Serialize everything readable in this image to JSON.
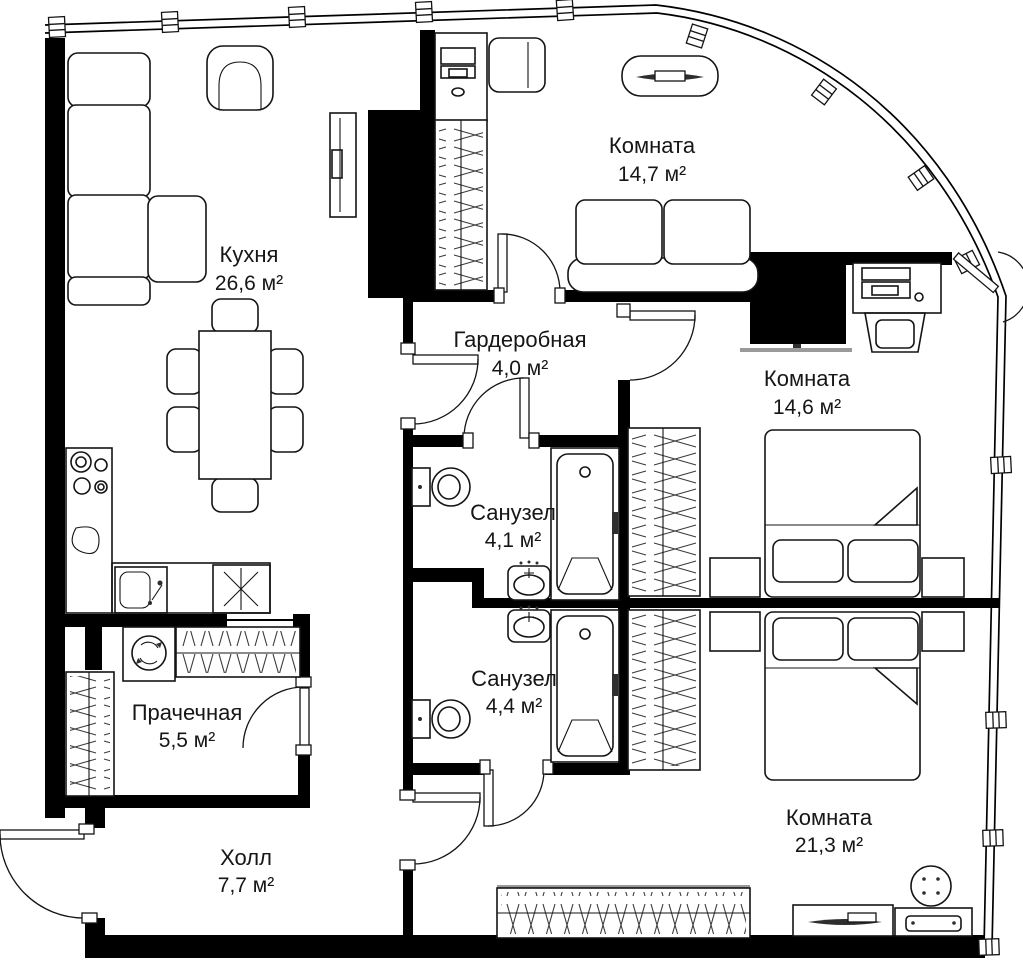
{
  "meta": {
    "type": "floor-plan",
    "language": "ru",
    "units": "м²"
  },
  "colors": {
    "walls": "#000000",
    "text": "#161616",
    "background": "#ffffff",
    "accents": "#9a9a9a"
  },
  "rooms": [
    {
      "id": "kitchen",
      "name": "Кухня",
      "area": "26,6 м²"
    },
    {
      "id": "room-14-7",
      "name": "Комната",
      "area": "14,7 м²"
    },
    {
      "id": "wardrobe",
      "name": "Гардеробная",
      "area": "4,0 м²"
    },
    {
      "id": "room-14-6",
      "name": "Комната",
      "area": "14,6 м²"
    },
    {
      "id": "bathroom-4-1",
      "name": "Санузел",
      "area": "4,1 м²"
    },
    {
      "id": "bathroom-4-4",
      "name": "Санузел",
      "area": "4,4 м²"
    },
    {
      "id": "laundry",
      "name": "Прачечная",
      "area": "5,5 м²"
    },
    {
      "id": "hall",
      "name": "Холл",
      "area": "7,7 м²"
    },
    {
      "id": "room-21-3",
      "name": "Комната",
      "area": "21,3 м²"
    }
  ]
}
